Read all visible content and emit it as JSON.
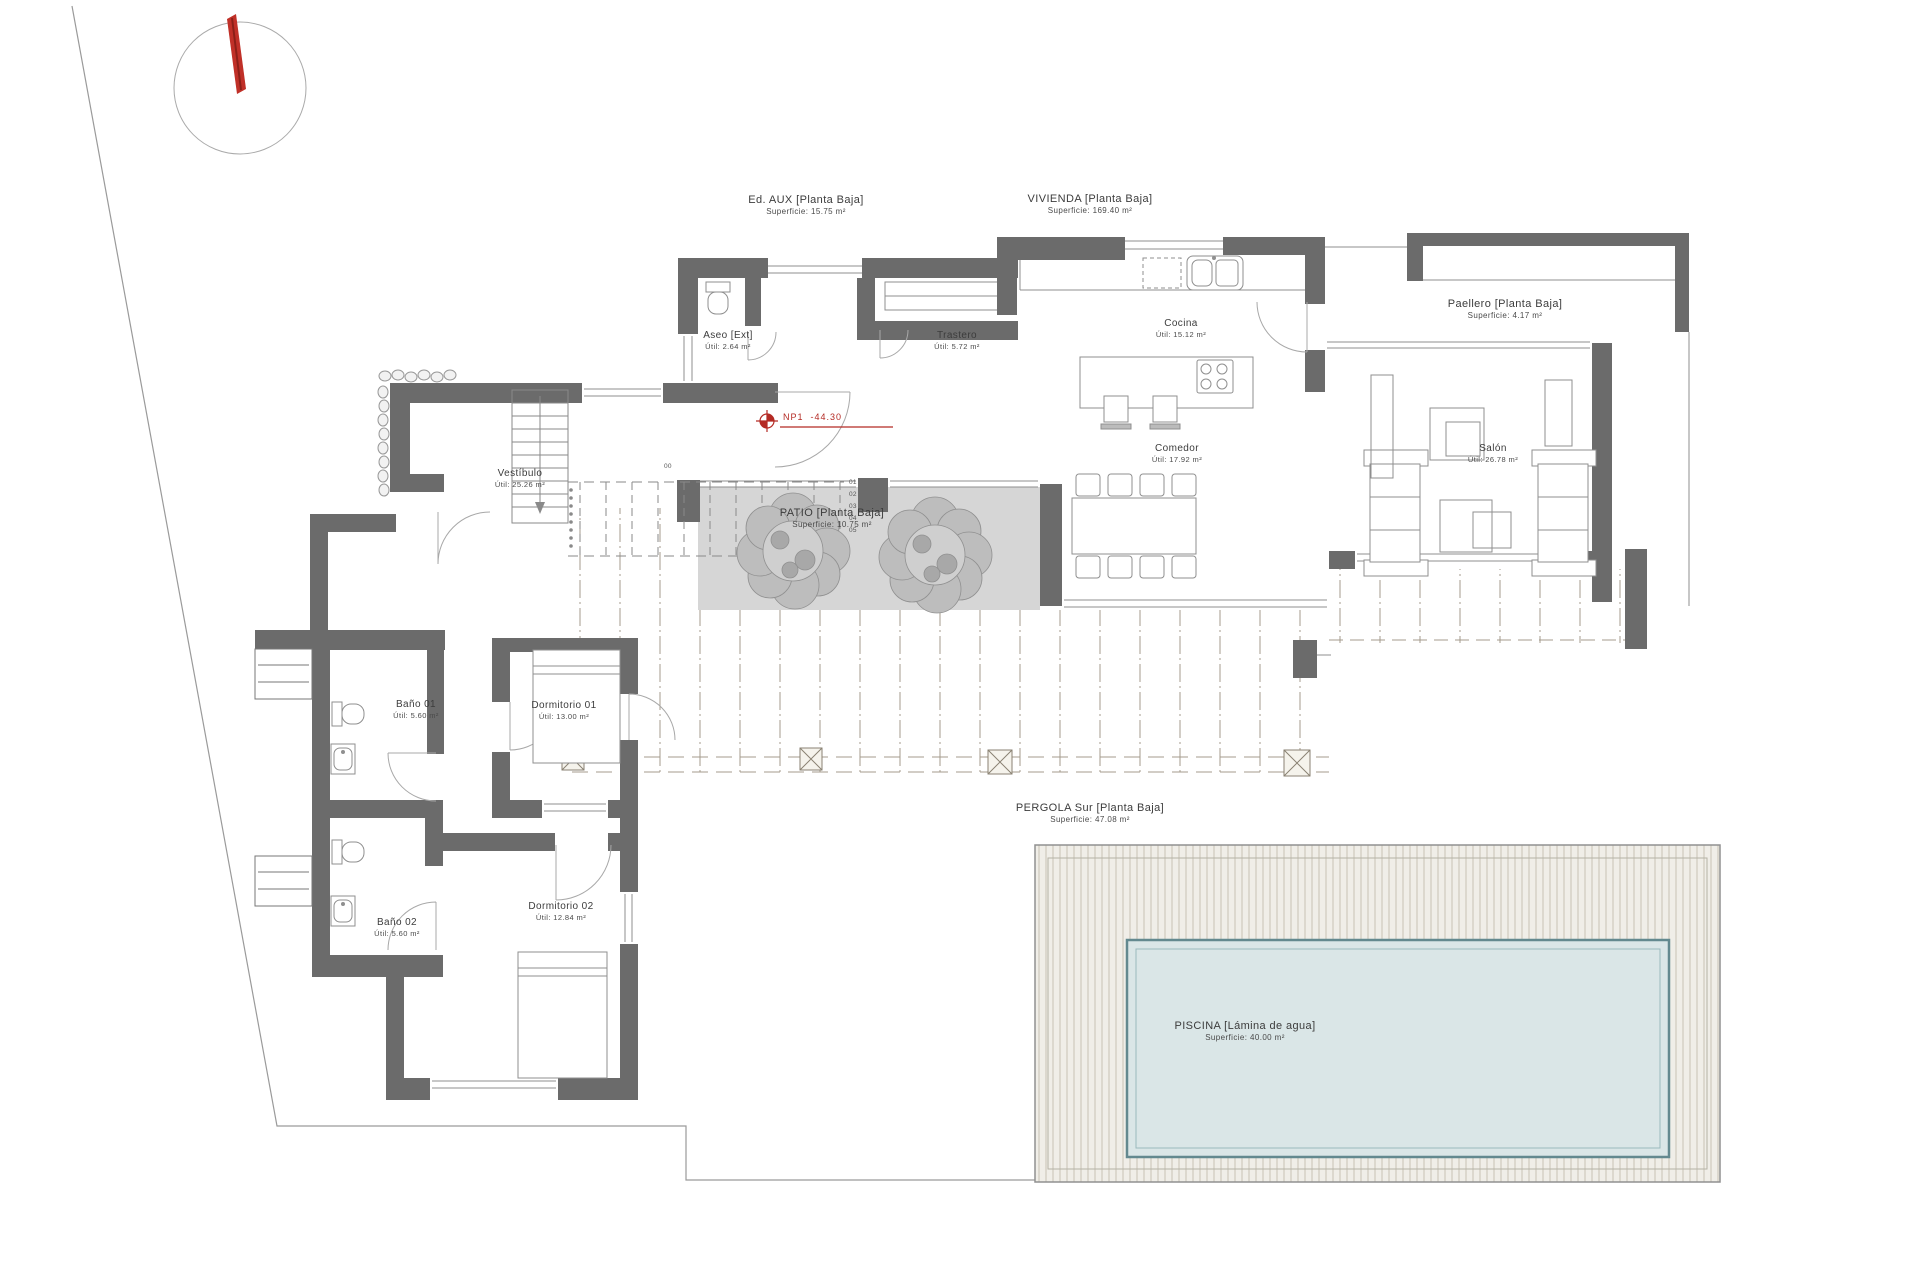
{
  "plan": {
    "areas": [
      {
        "key": "ed-aux",
        "name": "Ed. AUX [Planta Baja]",
        "area": "Superficie: 15.75 m²",
        "x": 806,
        "y": 193
      },
      {
        "key": "vivienda",
        "name": "VIVIENDA [Planta Baja]",
        "area": "Superficie: 169.40 m²",
        "x": 1090,
        "y": 192
      },
      {
        "key": "paellero",
        "name": "Paellero [Planta Baja]",
        "area": "Superficie: 4.17 m²",
        "x": 1505,
        "y": 297
      },
      {
        "key": "patio",
        "name": "PATIO [Planta Baja]",
        "area": "Superficie: 10.75 m²",
        "x": 832,
        "y": 506
      },
      {
        "key": "pergola",
        "name": "PERGOLA Sur [Planta Baja]",
        "area": "Superficie: 47.08 m²",
        "x": 1090,
        "y": 801
      },
      {
        "key": "piscina",
        "name": "PISCINA [Lámina de agua]",
        "area": "Superficie: 40.00 m²",
        "x": 1245,
        "y": 1019
      }
    ],
    "rooms": [
      {
        "key": "aseo",
        "name": "Aseo [Ext]",
        "area": "Útil: 2.64 m²",
        "x": 728,
        "y": 329
      },
      {
        "key": "trastero",
        "name": "Trastero",
        "area": "Útil: 5.72 m²",
        "x": 957,
        "y": 329
      },
      {
        "key": "cocina",
        "name": "Cocina",
        "area": "Útil: 15.12 m²",
        "x": 1181,
        "y": 317
      },
      {
        "key": "comedor",
        "name": "Comedor",
        "area": "Útil: 17.92 m²",
        "x": 1177,
        "y": 442
      },
      {
        "key": "salon",
        "name": "Salón",
        "area": "Útil: 26.78 m²",
        "x": 1493,
        "y": 442
      },
      {
        "key": "vestibulo",
        "name": "Vestíbulo",
        "area": "Útil: 25.26 m²",
        "x": 520,
        "y": 467
      },
      {
        "key": "bano-01",
        "name": "Baño 01",
        "area": "Útil: 5.60 m²",
        "x": 416,
        "y": 698
      },
      {
        "key": "dorm-01",
        "name": "Dormitorio 01",
        "area": "Útil: 13.00 m²",
        "x": 564,
        "y": 699
      },
      {
        "key": "bano-02",
        "name": "Baño 02",
        "area": "Útil: 5.60 m²",
        "x": 397,
        "y": 916
      },
      {
        "key": "dorm-02",
        "name": "Dormitorio 02",
        "area": "Útil: 12.84 m²",
        "x": 561,
        "y": 900
      }
    ],
    "benchmark": {
      "label": "NP1",
      "value": "-44.30"
    },
    "stairs": {
      "top_label": "00",
      "top_x": 664,
      "top_y": 463,
      "steps": [
        "01",
        "02",
        "03",
        "04",
        "05"
      ],
      "steps_x": 849,
      "steps_y0": 479,
      "steps_dy": 12
    },
    "colors": {
      "wall": "#6b6b6b",
      "line": "#8f8f8f",
      "accent_red": "#c03028",
      "patio_gray": "#d6d6d6",
      "tree_fill": "#bdbdbd",
      "deck_hatch": "#a49b8c",
      "deck_stripe_bg": "#f0eee8",
      "deck_stripe": "#c7c3b5",
      "pool_water": "#dae6e7",
      "pool_edge": "#63898f",
      "text": "#3c3c3c"
    }
  }
}
